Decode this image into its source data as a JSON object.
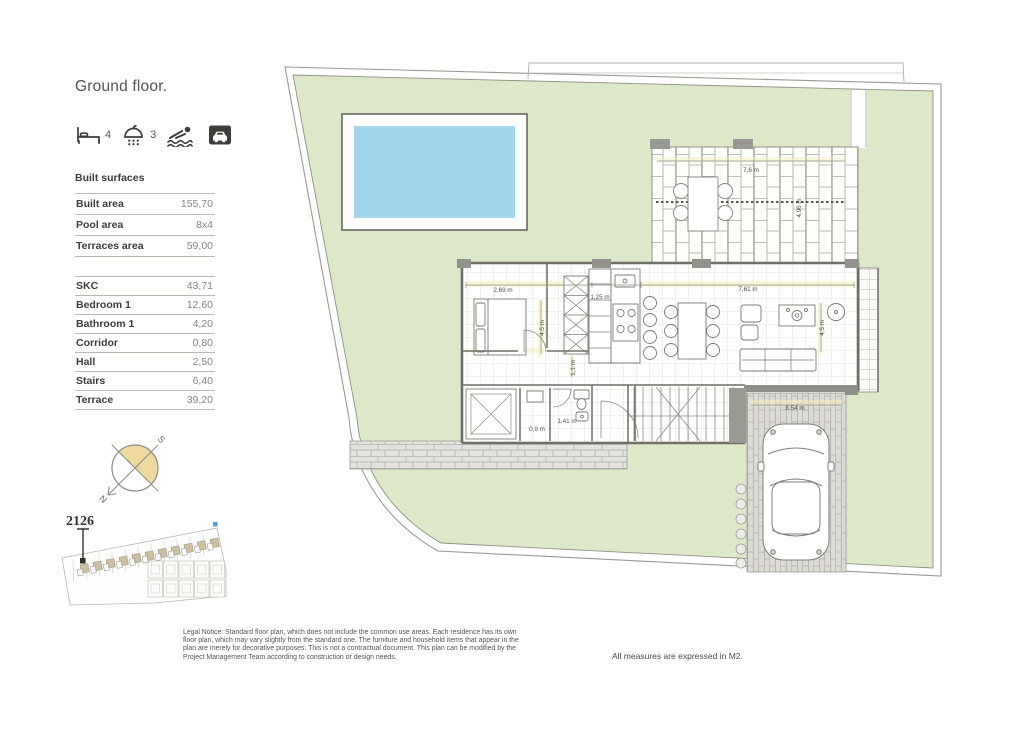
{
  "header": {
    "title": "Ground floor."
  },
  "features": {
    "bedrooms": "4",
    "bathrooms": "3"
  },
  "surfaces": {
    "title": "Built surfaces",
    "main": [
      {
        "label": "Built area",
        "value": "155,70"
      },
      {
        "label": "Pool area",
        "value": "8x4"
      },
      {
        "label": "Terraces area",
        "value": "59,00"
      }
    ],
    "rooms": [
      {
        "label": "SKC",
        "value": "43,71"
      },
      {
        "label": "Bedroom 1",
        "value": "12,60"
      },
      {
        "label": "Bathroom 1",
        "value": "4,20"
      },
      {
        "label": "Corridor",
        "value": "0,80"
      },
      {
        "label": "Hall",
        "value": "2,50"
      },
      {
        "label": "Stairs",
        "value": "6,40"
      },
      {
        "label": "Terrace",
        "value": "39,20"
      }
    ]
  },
  "compass": {
    "north": "N",
    "south": "S"
  },
  "sitemap": {
    "unit_number": "2126",
    "house_count": 11,
    "garage_rows": 2,
    "garage_cols": 5
  },
  "plan": {
    "dimensions": [
      {
        "text": "2,69 m",
        "x": 503,
        "y": 292,
        "rot": 0
      },
      {
        "text": "1,25 m",
        "x": 600,
        "y": 299,
        "rot": 0
      },
      {
        "text": "7,61 m",
        "x": 748,
        "y": 291,
        "rot": 0
      },
      {
        "text": "4,5 m",
        "x": 544,
        "y": 328,
        "rot": -90
      },
      {
        "text": "4,5 m",
        "x": 824,
        "y": 328,
        "rot": -90
      },
      {
        "text": "1,1 m",
        "x": 575,
        "y": 368,
        "rot": -90
      },
      {
        "text": "0,9 m",
        "x": 537,
        "y": 431,
        "rot": 0
      },
      {
        "text": "1,41 m",
        "x": 567,
        "y": 423,
        "rot": 0
      },
      {
        "text": "8,54 m",
        "x": 795,
        "y": 410,
        "rot": 0
      },
      {
        "text": "7,6 m",
        "x": 751,
        "y": 172,
        "rot": 0
      },
      {
        "text": "4,96 m",
        "x": 801,
        "y": 208,
        "rot": -90
      }
    ]
  },
  "footer": {
    "legal_notice": "Legal Notice: Standard floor plan, which does not include the common use areas. Each residence has its own floor plan, which may vary slightly from the standard one. The furniture and household items that appear in the plan are merely for decorative purposes. This is not a contractual document. This plan can be modified by the Project Management Team according to construction or design needs.",
    "units_note": "All measures are expressed in M2."
  },
  "colors": {
    "lawn": "#dde8c8",
    "pool_water": "#a3d6ee",
    "compass_fill": "#eed9a0",
    "wall": "#6f6f67",
    "paving": "#e0e0dc"
  }
}
